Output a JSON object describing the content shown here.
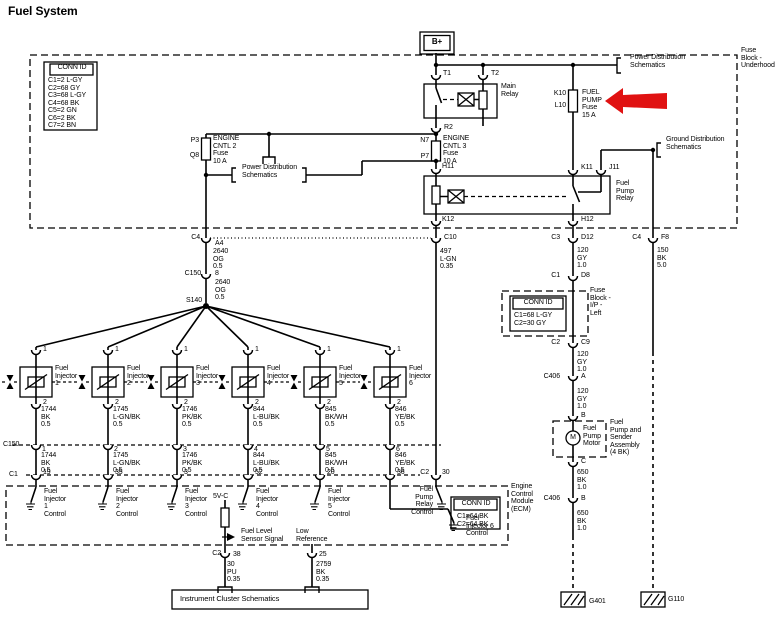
{
  "page": {
    "title": "Fuel System"
  },
  "colors": {
    "line": "#000000",
    "background": "#ffffff",
    "arrow_red": "#e01212"
  },
  "labels": [
    {
      "name": "diagram-title",
      "text": "Fuel System",
      "x": 8,
      "y": 5,
      "size": 12,
      "bold": true
    },
    {
      "name": "connid-underhood-header",
      "text": "CONN ID",
      "x": 50,
      "y": 64,
      "w": 44,
      "align": "center"
    },
    {
      "name": "connid-underhood-list",
      "text": "C1=2 L-GY\nC2=68 GY\nC3=68 L-GY\nC4=68 BK\nC5=2 GN\nC6=2 BK\nC7=2 BN",
      "x": 48,
      "y": 77
    },
    {
      "name": "battery-b-plus",
      "text": "B+",
      "x": 420,
      "y": 38,
      "w": 34,
      "align": "center",
      "bold": true,
      "size": 8
    },
    {
      "name": "terminal-t1",
      "text": "T1",
      "x": 443,
      "y": 70
    },
    {
      "name": "terminal-t2",
      "text": "T2",
      "x": 491,
      "y": 70
    },
    {
      "name": "main-relay-label",
      "text": "Main\nRelay",
      "x": 501,
      "y": 83
    },
    {
      "name": "terminal-r2",
      "text": "R2",
      "x": 444,
      "y": 124
    },
    {
      "name": "terminal-k10",
      "text": "K10",
      "x": 566,
      "y": 90,
      "align": "right"
    },
    {
      "name": "terminal-l10",
      "text": "L10",
      "x": 566,
      "y": 102,
      "align": "right"
    },
    {
      "name": "fuel-pump-fuse-label",
      "text": "FUEL\nPUMP\nFuse\n15 A",
      "x": 582,
      "y": 89
    },
    {
      "name": "power-dist-ref-top",
      "text": "Power Distribution\nSchematics",
      "x": 630,
      "y": 54
    },
    {
      "name": "fuse-block-underhood-label",
      "text": "Fuse\nBlock -\nUnderhood",
      "x": 741,
      "y": 47
    },
    {
      "name": "terminal-p3",
      "text": "P3",
      "x": 199,
      "y": 137,
      "align": "right"
    },
    {
      "name": "terminal-q8",
      "text": "Q8",
      "x": 199,
      "y": 152,
      "align": "right"
    },
    {
      "name": "engine-cntl2-fuse-label",
      "text": "ENGINE\nCNTL 2\nFuse\n10 A",
      "x": 213,
      "y": 135
    },
    {
      "name": "terminal-n7",
      "text": "N7",
      "x": 429,
      "y": 137,
      "align": "right"
    },
    {
      "name": "terminal-p7",
      "text": "P7",
      "x": 429,
      "y": 153,
      "align": "right"
    },
    {
      "name": "engine-cntl3-fuse-label",
      "text": "ENGINE\nCNTL 3\nFuse\n10 A",
      "x": 443,
      "y": 135
    },
    {
      "name": "power-dist-ref-mid",
      "text": "Power Distribution\nSchematics",
      "x": 242,
      "y": 164
    },
    {
      "name": "terminal-h11",
      "text": "H11",
      "x": 442,
      "y": 163
    },
    {
      "name": "terminal-k11",
      "text": "K11",
      "x": 581,
      "y": 164
    },
    {
      "name": "terminal-j11",
      "text": "J11",
      "x": 609,
      "y": 164
    },
    {
      "name": "fuel-pump-relay-label",
      "text": "Fuel\nPump\nRelay",
      "x": 616,
      "y": 180
    },
    {
      "name": "ground-dist-ref",
      "text": "Ground Distribution\nSchematics",
      "x": 666,
      "y": 136
    },
    {
      "name": "terminal-k12",
      "text": "K12",
      "x": 442,
      "y": 216
    },
    {
      "name": "terminal-h12",
      "text": "H12",
      "x": 581,
      "y": 216
    },
    {
      "name": "conn-c4-left",
      "text": "C4",
      "x": 200,
      "y": 234,
      "align": "right"
    },
    {
      "name": "pin-a4",
      "text": "A4",
      "x": 215,
      "y": 240
    },
    {
      "name": "wire-2640-og-a",
      "text": "2640\nOG\n0.5",
      "x": 213,
      "y": 248
    },
    {
      "name": "conn-c150-mid",
      "text": "C150",
      "x": 201,
      "y": 270,
      "align": "right"
    },
    {
      "name": "pin-8",
      "text": "8",
      "x": 215,
      "y": 270
    },
    {
      "name": "wire-2640-og-b",
      "text": "2640\nOG\n0.5",
      "x": 215,
      "y": 279
    },
    {
      "name": "splice-s140",
      "text": "S140",
      "x": 202,
      "y": 297,
      "align": "right"
    },
    {
      "name": "conn-c10",
      "text": "C10",
      "x": 444,
      "y": 234
    },
    {
      "name": "wire-497-lgn",
      "text": "497\nL-GN\n0.35",
      "x": 440,
      "y": 248
    },
    {
      "name": "conn-c3",
      "text": "C3",
      "x": 560,
      "y": 234,
      "align": "right"
    },
    {
      "name": "pin-d12",
      "text": "D12",
      "x": 581,
      "y": 234
    },
    {
      "name": "wire-120-gy-a",
      "text": "120\nGY\n1.0",
      "x": 577,
      "y": 247
    },
    {
      "name": "conn-c4-right",
      "text": "C4",
      "x": 641,
      "y": 234,
      "align": "right"
    },
    {
      "name": "pin-f8",
      "text": "F8",
      "x": 661,
      "y": 234
    },
    {
      "name": "wire-150-bk",
      "text": "150\nBK\n5.0",
      "x": 657,
      "y": 247
    },
    {
      "name": "conn-c1-ip",
      "text": "C1",
      "x": 560,
      "y": 272,
      "align": "right"
    },
    {
      "name": "pin-d8",
      "text": "D8",
      "x": 581,
      "y": 272
    },
    {
      "name": "fuse-block-ip-label",
      "text": "Fuse\nBlock -\nI/P -\nLeft",
      "x": 590,
      "y": 287
    },
    {
      "name": "connid-ip-header",
      "text": "CONN ID",
      "x": 513,
      "y": 299,
      "w": 50,
      "align": "center"
    },
    {
      "name": "connid-ip-list",
      "text": "C1=68 L-GY\nC2=30 GY",
      "x": 514,
      "y": 312
    },
    {
      "name": "conn-c2-ip",
      "text": "C2",
      "x": 560,
      "y": 339,
      "align": "right"
    },
    {
      "name": "pin-c9",
      "text": "C9",
      "x": 581,
      "y": 339
    },
    {
      "name": "wire-120-gy-b",
      "text": "120\nGY\n1.0",
      "x": 577,
      "y": 351
    },
    {
      "name": "conn-c406-a",
      "text": "C406",
      "x": 560,
      "y": 373,
      "align": "right"
    },
    {
      "name": "pin-a",
      "text": "A",
      "x": 581,
      "y": 373
    },
    {
      "name": "wire-120-gy-c",
      "text": "120\nGY\n1.0",
      "x": 577,
      "y": 388
    },
    {
      "name": "pin-b",
      "text": "B",
      "x": 581,
      "y": 412
    },
    {
      "name": "motor-m",
      "text": "M",
      "x": 566,
      "y": 434,
      "w": 14,
      "align": "center"
    },
    {
      "name": "fuel-pump-motor-label",
      "text": "Fuel\nPump\nMotor",
      "x": 583,
      "y": 425
    },
    {
      "name": "fuel-pump-assembly-label",
      "text": "Fuel\nPump and\nSender\nAssembly\n(4 BK)",
      "x": 610,
      "y": 419
    },
    {
      "name": "pin-c",
      "text": "C",
      "x": 581,
      "y": 458
    },
    {
      "name": "wire-650-bk-a",
      "text": "650\nBK\n1.0",
      "x": 577,
      "y": 469
    },
    {
      "name": "conn-c406-b",
      "text": "C406",
      "x": 560,
      "y": 495,
      "align": "right"
    },
    {
      "name": "pin-b2",
      "text": "B",
      "x": 581,
      "y": 495
    },
    {
      "name": "wire-650-bk-b",
      "text": "650\nBK\n1.0",
      "x": 577,
      "y": 510
    },
    {
      "name": "ground-g401",
      "text": "G401",
      "x": 589,
      "y": 598
    },
    {
      "name": "ground-g110",
      "text": "G110",
      "x": 668,
      "y": 596
    },
    {
      "name": "injector-1-label",
      "text": "Fuel\nInjector\n1",
      "x": 55,
      "y": 365
    },
    {
      "name": "injector-2-label",
      "text": "Fuel\nInjector\n2",
      "x": 127,
      "y": 365
    },
    {
      "name": "injector-3-label",
      "text": "Fuel\nInjector\n3",
      "x": 196,
      "y": 365
    },
    {
      "name": "injector-4-label",
      "text": "Fuel\nInjector\n4",
      "x": 267,
      "y": 365
    },
    {
      "name": "injector-5-label",
      "text": "Fuel\nInjector\n5",
      "x": 339,
      "y": 365
    },
    {
      "name": "injector-6-label",
      "text": "Fuel\nInjector\n6",
      "x": 409,
      "y": 365
    },
    {
      "name": "injector-1-pin1",
      "text": "1",
      "x": 43,
      "y": 346
    },
    {
      "name": "injector-2-pin1",
      "text": "1",
      "x": 115,
      "y": 346
    },
    {
      "name": "injector-3-pin1",
      "text": "1",
      "x": 184,
      "y": 346
    },
    {
      "name": "injector-4-pin1",
      "text": "1",
      "x": 255,
      "y": 346
    },
    {
      "name": "injector-5-pin1",
      "text": "1",
      "x": 327,
      "y": 346
    },
    {
      "name": "injector-6-pin1",
      "text": "1",
      "x": 397,
      "y": 346
    },
    {
      "name": "injector-1-pin2",
      "text": "2",
      "x": 43,
      "y": 399
    },
    {
      "name": "injector-2-pin2",
      "text": "2",
      "x": 115,
      "y": 399
    },
    {
      "name": "injector-3-pin2",
      "text": "2",
      "x": 184,
      "y": 399
    },
    {
      "name": "injector-4-pin2",
      "text": "2",
      "x": 255,
      "y": 399
    },
    {
      "name": "injector-5-pin2",
      "text": "2",
      "x": 327,
      "y": 399
    },
    {
      "name": "injector-6-pin2",
      "text": "2",
      "x": 397,
      "y": 399
    },
    {
      "name": "injector-1-wire-upper",
      "text": "1744\nBK\n0.5",
      "x": 41,
      "y": 406
    },
    {
      "name": "injector-2-wire-upper",
      "text": "1745\nL-GN/BK\n0.5",
      "x": 113,
      "y": 406
    },
    {
      "name": "injector-3-wire-upper",
      "text": "1746\nPK/BK\n0.5",
      "x": 182,
      "y": 406
    },
    {
      "name": "injector-4-wire-upper",
      "text": "844\nL-BU/BK\n0.5",
      "x": 253,
      "y": 406
    },
    {
      "name": "injector-5-wire-upper",
      "text": "845\nBK/WH\n0.5",
      "x": 325,
      "y": 406
    },
    {
      "name": "injector-6-wire-upper",
      "text": "846\nYE/BK\n0.5",
      "x": 395,
      "y": 406
    },
    {
      "name": "injector-1-c150-pin",
      "text": "1",
      "x": 42,
      "y": 446
    },
    {
      "name": "injector-2-c150-pin",
      "text": "2",
      "x": 114,
      "y": 446
    },
    {
      "name": "injector-3-c150-pin",
      "text": "3",
      "x": 183,
      "y": 446
    },
    {
      "name": "injector-4-c150-pin",
      "text": "4",
      "x": 254,
      "y": 446
    },
    {
      "name": "injector-5-c150-pin",
      "text": "5",
      "x": 326,
      "y": 446
    },
    {
      "name": "injector-6-c150-pin",
      "text": "6",
      "x": 396,
      "y": 446
    },
    {
      "name": "injector-1-wire-lower",
      "text": "1744\nBK\n0.5",
      "x": 41,
      "y": 452
    },
    {
      "name": "injector-2-wire-lower",
      "text": "1745\nL-GN/BK\n0.5",
      "x": 113,
      "y": 452
    },
    {
      "name": "injector-3-wire-lower",
      "text": "1746\nPK/BK\n0.5",
      "x": 182,
      "y": 452
    },
    {
      "name": "injector-4-wire-lower",
      "text": "844\nL-BU/BK\n0.5",
      "x": 253,
      "y": 452
    },
    {
      "name": "injector-5-wire-lower",
      "text": "845\nBK/WH\n0.5",
      "x": 325,
      "y": 452
    },
    {
      "name": "injector-6-wire-lower",
      "text": "846\nYE/BK\n0.5",
      "x": 395,
      "y": 452
    },
    {
      "name": "injector-1-ecm-pin",
      "text": "19",
      "x": 43,
      "y": 469
    },
    {
      "name": "injector-2-ecm-pin",
      "text": "35",
      "x": 115,
      "y": 469
    },
    {
      "name": "injector-3-ecm-pin",
      "text": "3",
      "x": 184,
      "y": 469
    },
    {
      "name": "injector-4-ecm-pin",
      "text": "52",
      "x": 255,
      "y": 469
    },
    {
      "name": "injector-5-ecm-pin",
      "text": "20",
      "x": 327,
      "y": 469
    },
    {
      "name": "injector-6-ecm-pin",
      "text": "36",
      "x": 397,
      "y": 469
    },
    {
      "name": "conn-c150-left",
      "text": "C150",
      "x": 3,
      "y": 441
    },
    {
      "name": "conn-c1-left",
      "text": "C1",
      "x": 9,
      "y": 471
    },
    {
      "name": "conn-c2-ecm",
      "text": "C2",
      "x": 429,
      "y": 469,
      "align": "right"
    },
    {
      "name": "pin-30",
      "text": "30",
      "x": 442,
      "y": 469
    },
    {
      "name": "ecm-injector-1-control",
      "text": "Fuel\nInjector\n1\nControl",
      "x": 44,
      "y": 488
    },
    {
      "name": "ecm-injector-2-control",
      "text": "Fuel\nInjector\n2\nControl",
      "x": 116,
      "y": 488
    },
    {
      "name": "ecm-injector-3-control",
      "text": "Fuel\nInjector\n3\nControl",
      "x": 185,
      "y": 488
    },
    {
      "name": "ecm-injector-4-control",
      "text": "Fuel\nInjector\n4\nControl",
      "x": 256,
      "y": 488
    },
    {
      "name": "ecm-injector-5-control",
      "text": "Fuel\nInjector\n5\nControl",
      "x": 328,
      "y": 488
    },
    {
      "name": "ecm-injector-6-control",
      "text": "Fuel\nInjector 6\nControl",
      "x": 466,
      "y": 515
    },
    {
      "name": "ecm-fuel-pump-relay-control",
      "text": "Fuel\nPump\nRelay\nControl",
      "x": 433,
      "y": 486,
      "align": "right"
    },
    {
      "name": "ecm-5v-ref",
      "text": "5V-C",
      "x": 213,
      "y": 493
    },
    {
      "name": "fuel-level-sensor-signal",
      "text": "Fuel Level\nSensor Signal",
      "x": 241,
      "y": 528
    },
    {
      "name": "low-reference",
      "text": "Low\nReference",
      "x": 296,
      "y": 528
    },
    {
      "name": "conn-c2-bottom",
      "text": "C2",
      "x": 221,
      "y": 550,
      "align": "right"
    },
    {
      "name": "pin-38",
      "text": "38",
      "x": 233,
      "y": 551
    },
    {
      "name": "wire-30-pu",
      "text": "30\nPU\n0.35",
      "x": 227,
      "y": 561
    },
    {
      "name": "pin-25",
      "text": "25",
      "x": 319,
      "y": 551
    },
    {
      "name": "wire-2759-bk",
      "text": "2759\nBK\n0.35",
      "x": 316,
      "y": 561
    },
    {
      "name": "instrument-cluster-ref",
      "text": "Instrument Cluster Schematics",
      "x": 180,
      "y": 595,
      "size": 7.5
    },
    {
      "name": "connid-ecm-header",
      "text": "CONN ID",
      "x": 455,
      "y": 500,
      "w": 42,
      "align": "center"
    },
    {
      "name": "connid-ecm-list",
      "text": "C1=64 BK\nC2=64 BK",
      "x": 457,
      "y": 513
    },
    {
      "name": "ecm-label",
      "text": "Engine\nControl\nModule\n(ECM)",
      "x": 511,
      "y": 483
    }
  ]
}
